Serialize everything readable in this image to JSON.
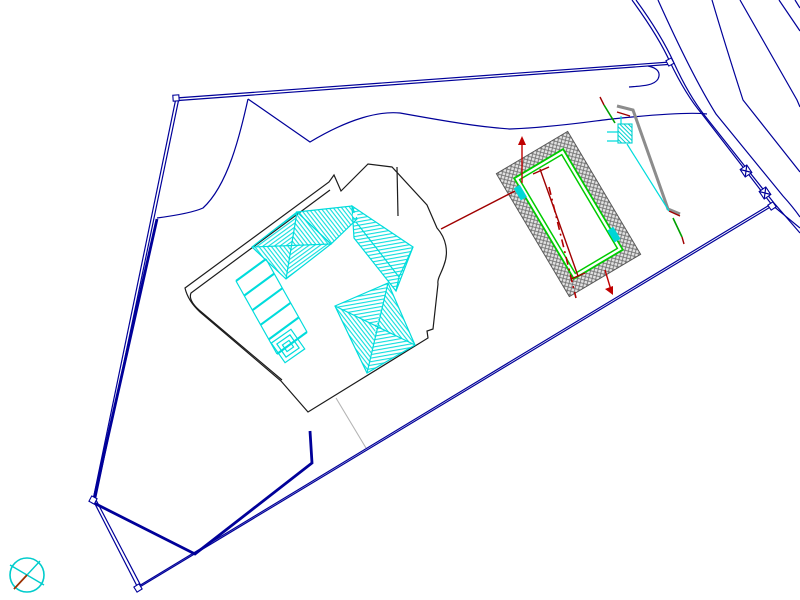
{
  "drawing": {
    "kind": "architectural site plan",
    "background": "#ffffff",
    "visible_text": []
  },
  "colors": {
    "bg": "#ffffff",
    "boundary_navy": "#000099",
    "outline_black": "#1c1c1c",
    "roof_cyan": "#00dcdc",
    "pool_green": "#00cc00",
    "dark_red": "#a00000",
    "bright_red": "#c00000",
    "centerline_red": "#b00000",
    "wall_gray": "#8c8c8c",
    "stone_gray": "#707070",
    "stone_bg": "#e3e3e3",
    "light_gray": "#b4b4b4",
    "compass_cyan": "#00cccc",
    "compass_needle_red": "#a03000",
    "accent_green": "#00a000"
  },
  "symbols": {
    "north_symbol": "crossed-circle",
    "corner_marker": "small-square",
    "road_marker": "crossed-box",
    "pool_ladder": "cyan-rect",
    "wall_ladder": "hatched-rect-with-rungs"
  },
  "features": {
    "boundary_corner_count": 5,
    "road_line_count": 7,
    "roof_section_count": 4,
    "pool_ladder_count": 2,
    "pergola_beam_count": 6
  }
}
